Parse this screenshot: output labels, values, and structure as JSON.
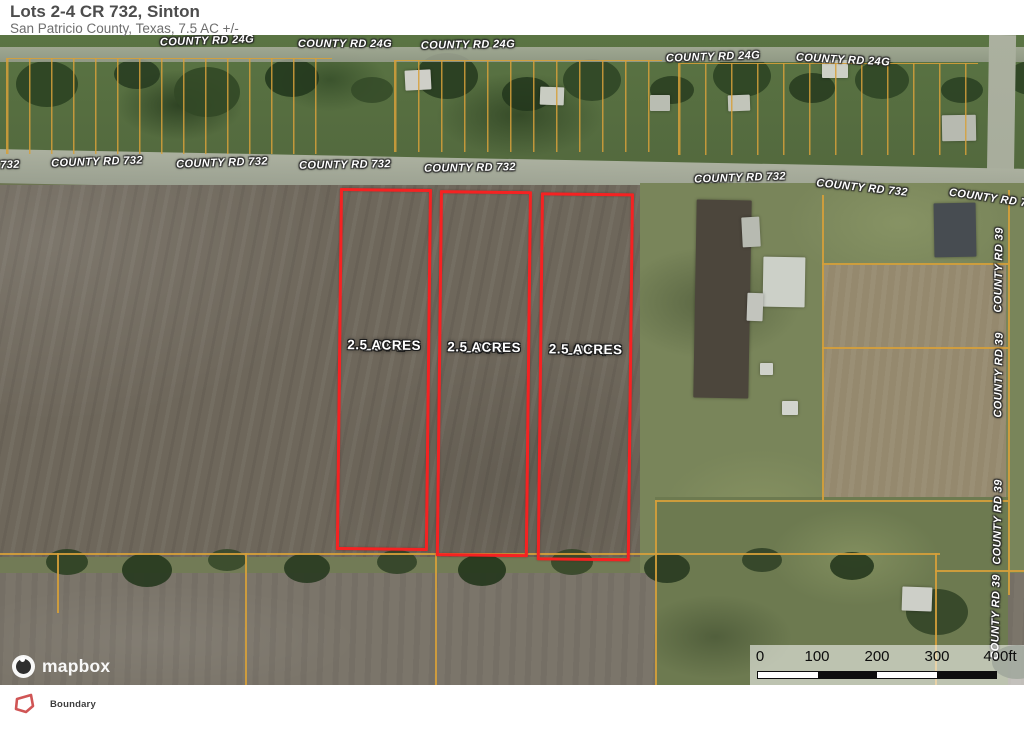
{
  "header": {
    "title": "Lots 2-4 CR 732, Sinton",
    "subtitle": "San Patricio County, Texas, 7.5 AC +/-"
  },
  "map": {
    "lots": [
      {
        "name": "LOT 2",
        "acres": "2.5 ACRES"
      },
      {
        "name": "LOT 3",
        "acres": "2.5 ACRES"
      },
      {
        "name": "LOT 4",
        "acres": "2.5 ACRES"
      }
    ],
    "road_labels": {
      "cr24g": "COUNTY RD 24G",
      "cr732": "COUNTY RD 732",
      "cr732_left_partial": "732",
      "cr732_right_partial": "COUNTY RD 7",
      "cr39": "COUNTY RD 39"
    },
    "attribution": "mapbox",
    "scale": {
      "ticks": [
        "0",
        "100",
        "200",
        "300",
        "400ft"
      ]
    }
  },
  "legend": {
    "boundary_label": "Boundary"
  },
  "colors": {
    "boundary_red": "#f52222",
    "parcel_orange": "#d6a03a",
    "plowed_field": "#6e675b",
    "pasture_green": "#79855a",
    "road_gray": "#a3a899"
  }
}
